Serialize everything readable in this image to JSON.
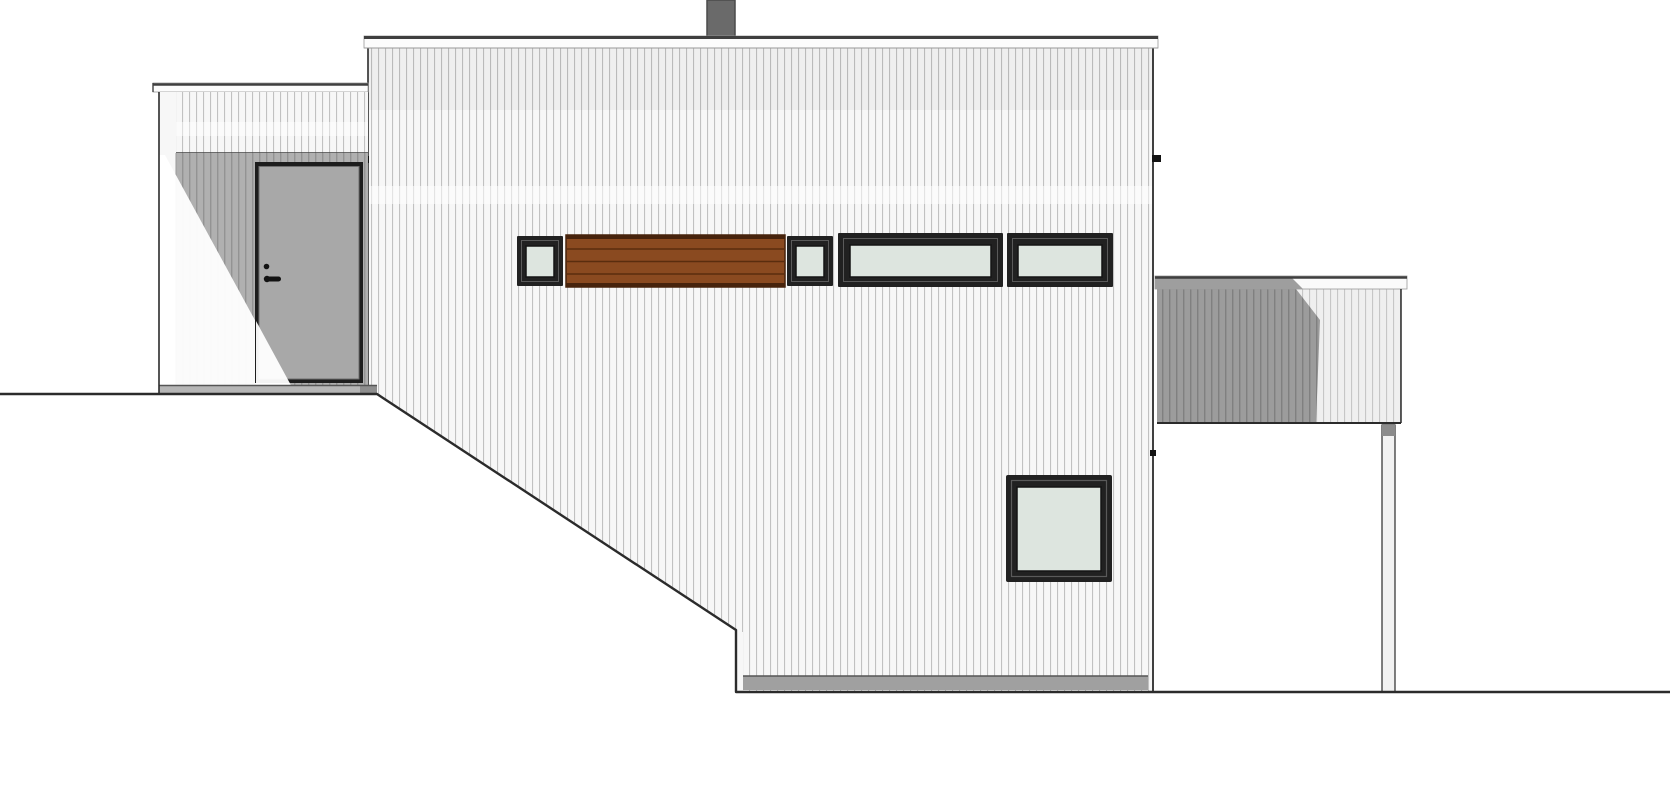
{
  "colors": {
    "background": "#ffffff",
    "outline": "#2b2b2b",
    "siding_light_bg": "#f7f7f7",
    "siding_light_line": "#c1c1c1",
    "siding_shade_bg": "#b0b0b0",
    "siding_shade_line": "#939393",
    "terrace_dark_bg": "#9c9c9c",
    "terrace_dark_line": "#808080",
    "terrace_light_bg": "#efefef",
    "terrace_light_line": "#c6c6c6",
    "fascia": "#fcfcfc",
    "fascia_edge": "#3f3f3f",
    "fascia_underside": "#999999",
    "chimney": "#6a6a6a",
    "chimney_edge": "#4a4a4a",
    "window_frame": "#212121",
    "window_frame_inner": "#5a5a5a",
    "glass": "#dde5df",
    "glass_edge": "#141414",
    "wood_panel": "#8a4a20",
    "wood_line": "#5a2d0e",
    "wood_edge": "#47230c",
    "door_frame": "#1d1d1d",
    "door_leaf": "#a8a8a8",
    "door_leaf_edge": "#6e6e6e",
    "hardware": "#121212",
    "base_strip": "#a0a0a0",
    "base_strip_edge": "#555555",
    "porch_base": "#b6b6b6",
    "porch_base_dark": "#8e8e8e",
    "rail_cap": "#fafafa",
    "rail_cap_shadow": "#9e9e9e",
    "post": "#f2f2f2",
    "post_cap": "#8b8b8b",
    "corner_board": "#f7f7f7",
    "corner_board_edge": "#9a9a9a",
    "highlight": "#ffffff",
    "top_tint": "rgba(0,0,0,0.03)",
    "sun_lit": "rgba(255,255,255,0.95)"
  }
}
